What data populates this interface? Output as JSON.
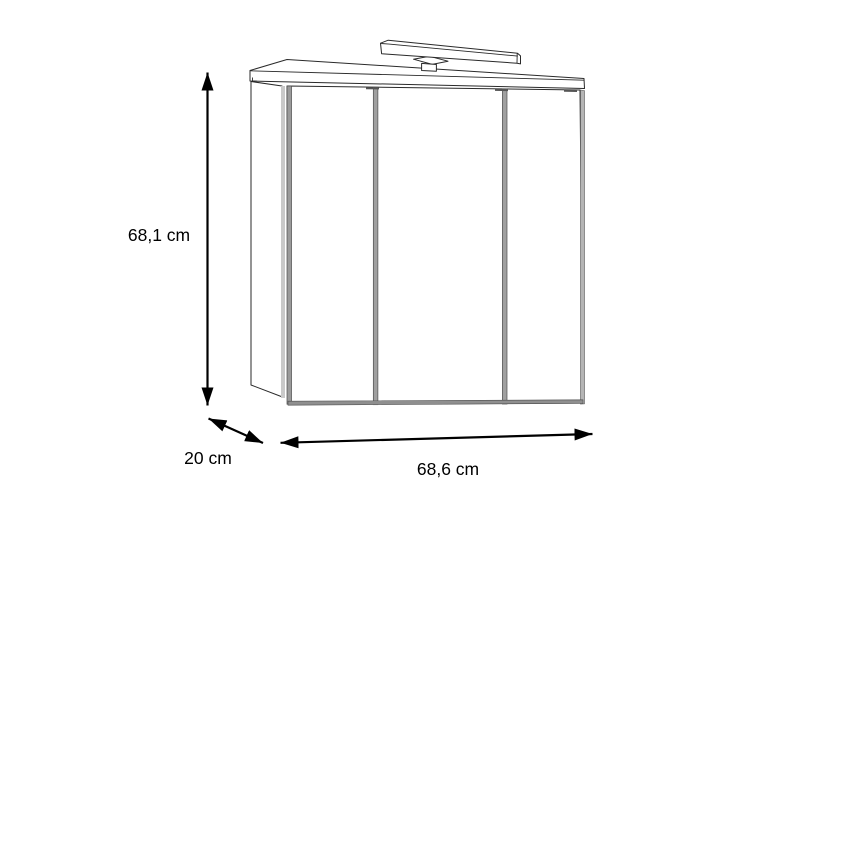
{
  "figure": {
    "type": "technical-dimension-drawing",
    "subject": "bathroom mirror cabinet with 3 mirror doors and top light bar",
    "dimensions": {
      "height": "68,1 cm",
      "depth": "20 cm",
      "width": "68,6 cm"
    },
    "colors": {
      "background": "#ffffff",
      "outline": "#2a2a2a",
      "dimension": "#000000",
      "door_gap_gray": "#a0a0a0",
      "door_gap_edge": "#4f4f4f",
      "carcass_edge_gray": "#c9c9c9",
      "bottom_shadow_gray": "#8f8f8f",
      "right_edge_gray": "#b5b5b5"
    },
    "parts": [
      "top-panel",
      "left-side-panel",
      "mirror-door-left",
      "mirror-door-center",
      "mirror-door-right",
      "led-light-bar"
    ]
  }
}
